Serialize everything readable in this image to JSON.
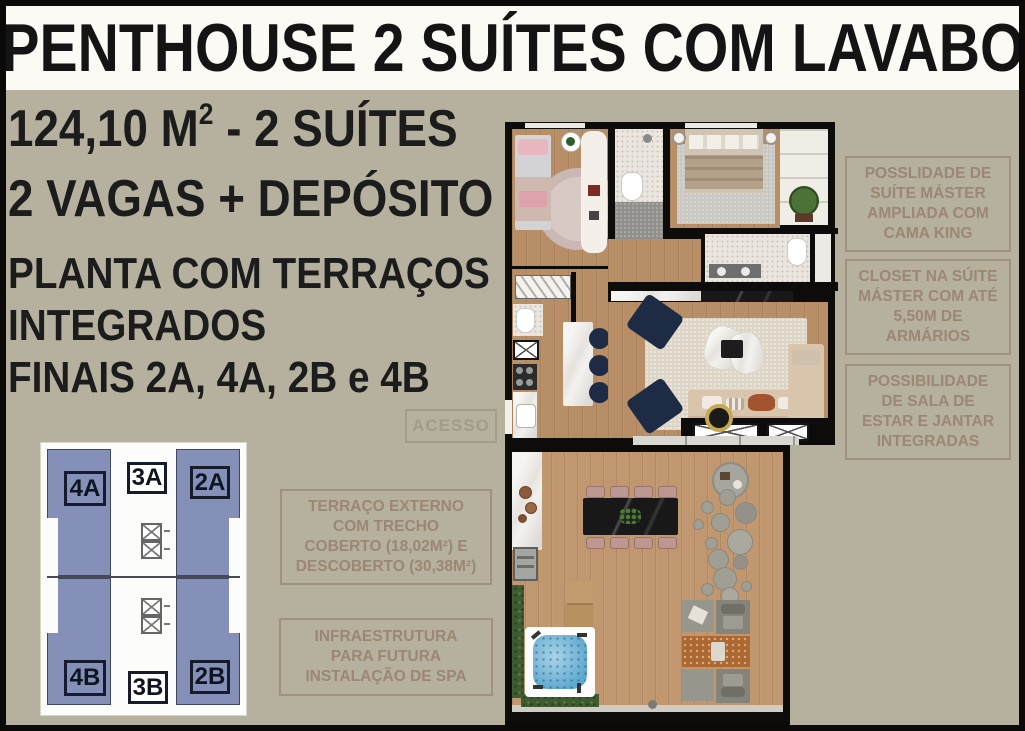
{
  "title": "PENTHOUSE 2 SUÍTES COM LAVABO",
  "specs": {
    "area_prefix": "124,10 M",
    "area_sup": "2",
    "area_suffix": " - 2 SUÍTES",
    "parking": "2 VAGAS + DEPÓSITO"
  },
  "plan_note": {
    "line1": "PLANTA COM TERRAÇOS",
    "line2": "INTEGRADOS",
    "line3": "FINAIS 2A, 4A, 2B e 4B"
  },
  "access_label": "ACESSO",
  "notes_left": [
    {
      "lines": [
        "TERRAÇO EXTERNO",
        "COM TRECHO",
        "COBERTO (18,02M²) E",
        "DESCOBERTO (30,38M²)"
      ]
    },
    {
      "lines": [
        "INFRAESTRUTURA",
        "PARA FUTURA",
        "INSTALAÇÃO DE SPA"
      ]
    }
  ],
  "notes_right": [
    {
      "lines": [
        "POSSLIDADE DE",
        "SUÍTE MÁSTER",
        "AMPLIADA COM",
        "CAMA KING"
      ]
    },
    {
      "lines": [
        "CLOSET NA SÚITE",
        "MÁSTER COM ATÉ",
        "5,50M DE",
        "ARMÁRIOS"
      ]
    },
    {
      "lines": [
        "POSSIBILIDADE",
        "DE SALA DE",
        "ESTAR E JANTAR",
        "INTEGRADAS"
      ]
    }
  ],
  "keyplan": {
    "top_units": [
      "4A",
      "3A",
      "2A"
    ],
    "bottom_units": [
      "4B",
      "3B",
      "2B"
    ]
  },
  "colors": {
    "background": "#b5b19e",
    "note_text": "#9a8571",
    "unit_highlight": "#8590b8",
    "wood_floor": "#b78e66",
    "terrace_floor": "#c0976f",
    "navy_furniture": "#1e2b44",
    "spa_water": "#6fb0d6",
    "hedge_green": "#3f5c30",
    "outdoor_rug_orange": "#ad6832",
    "dining_chair_mauve": "#bd9790"
  }
}
